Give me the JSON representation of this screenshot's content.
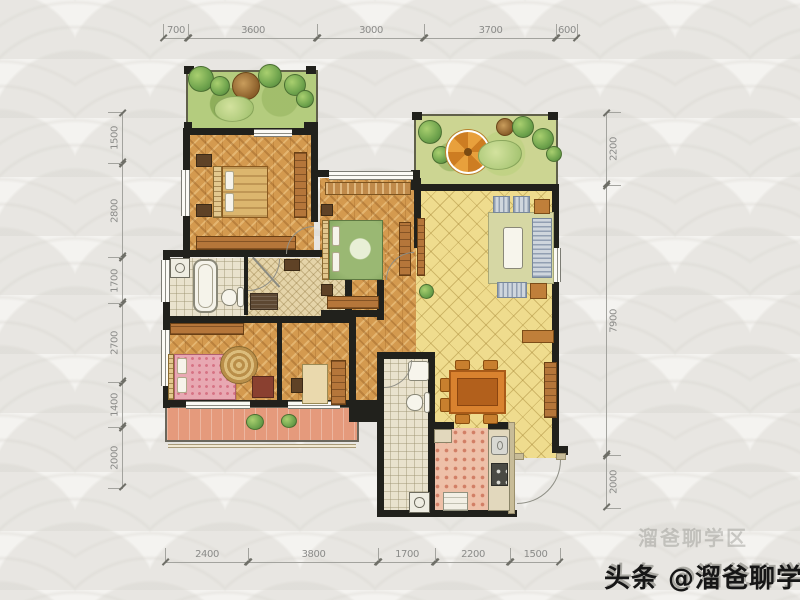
{
  "plan_type": "apartment-floor-plan",
  "dimensions": {
    "top": [
      "700",
      "3600",
      "3000",
      "3700",
      "600"
    ],
    "bottom": [
      "2400",
      "3800",
      "1700",
      "2200",
      "1500"
    ],
    "left": [
      "1500",
      "2800",
      "1700",
      "2700",
      "1400",
      "2000"
    ],
    "right": [
      "2200",
      "7900",
      "2000"
    ]
  },
  "watermark": {
    "main": "头条 @溜爸聊学区",
    "ghost": "溜爸聊学区"
  },
  "palette": {
    "wall": "#21211c",
    "wood": "#d49a4f",
    "ytile": "#efdc8e",
    "btile": "#e9e2cd",
    "ktile": "#eec0a8",
    "salmon": "#e59a7c",
    "garden": "#b4cc7e",
    "umbrella": "#e0952f",
    "dim": "#8b8b89"
  },
  "rooms": [
    {
      "name": "garden-balcony",
      "floor": "garden"
    },
    {
      "name": "terrace",
      "floor": "garden"
    },
    {
      "name": "master-bedroom",
      "floor": "wood"
    },
    {
      "name": "bedroom-2",
      "floor": "wood"
    },
    {
      "name": "bedroom-3",
      "floor": "wood"
    },
    {
      "name": "study",
      "floor": "wood"
    },
    {
      "name": "corridor",
      "floor": "wood"
    },
    {
      "name": "living-dining",
      "floor": "yellow-tile"
    },
    {
      "name": "master-bathroom",
      "floor": "tile"
    },
    {
      "name": "cloakroom",
      "floor": "tile"
    },
    {
      "name": "bathroom-2",
      "floor": "tile"
    },
    {
      "name": "kitchen",
      "floor": "pink-tile"
    },
    {
      "name": "balcony",
      "floor": "terracotta"
    }
  ]
}
